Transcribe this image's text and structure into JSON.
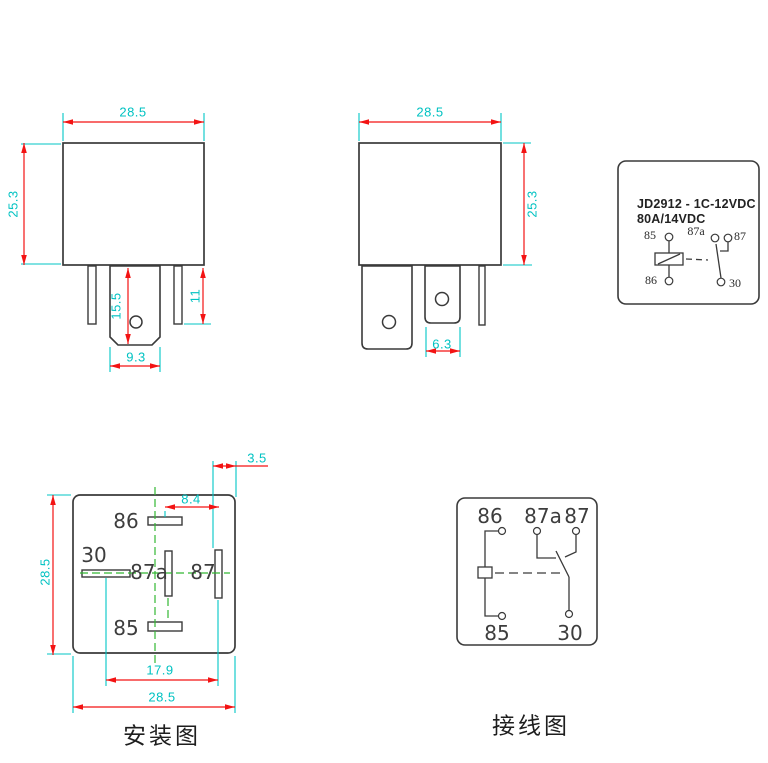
{
  "front_view": {
    "dim_width": "28.5",
    "dim_height": "25.3",
    "dim_pin_length": "15.5",
    "dim_side_pin_length": "11",
    "dim_pin_width": "9.3"
  },
  "side_view": {
    "dim_width": "28.5",
    "dim_height": "25.3",
    "dim_pin_width": "6.3"
  },
  "schematic": {
    "title_line1": "JD2912 - 1C-12VDC",
    "title_line2": "80A/14VDC",
    "pin_85": "85",
    "pin_86": "86",
    "pin_87a": "87a",
    "pin_87": "87",
    "pin_30": "30"
  },
  "mounting": {
    "caption": "安装图",
    "pin_86": "86",
    "pin_30": "30",
    "pin_87a": "87a",
    "pin_87": "87",
    "pin_85": "85",
    "dim_edge_offset": "3.5",
    "dim_pin_offset": "8.4",
    "dim_height": "28.5",
    "dim_pin_span": "17.9",
    "dim_width": "28.5"
  },
  "wiring": {
    "caption": "接线图",
    "pin_86": "86",
    "pin_87a": "87a",
    "pin_87": "87",
    "pin_85": "85",
    "pin_30": "30"
  },
  "colors": {
    "dimension_red": "#f31313",
    "dimension_cyan": "#00c6c6",
    "centerline_green": "#33b833",
    "outline_dark": "#3a3a3a"
  }
}
